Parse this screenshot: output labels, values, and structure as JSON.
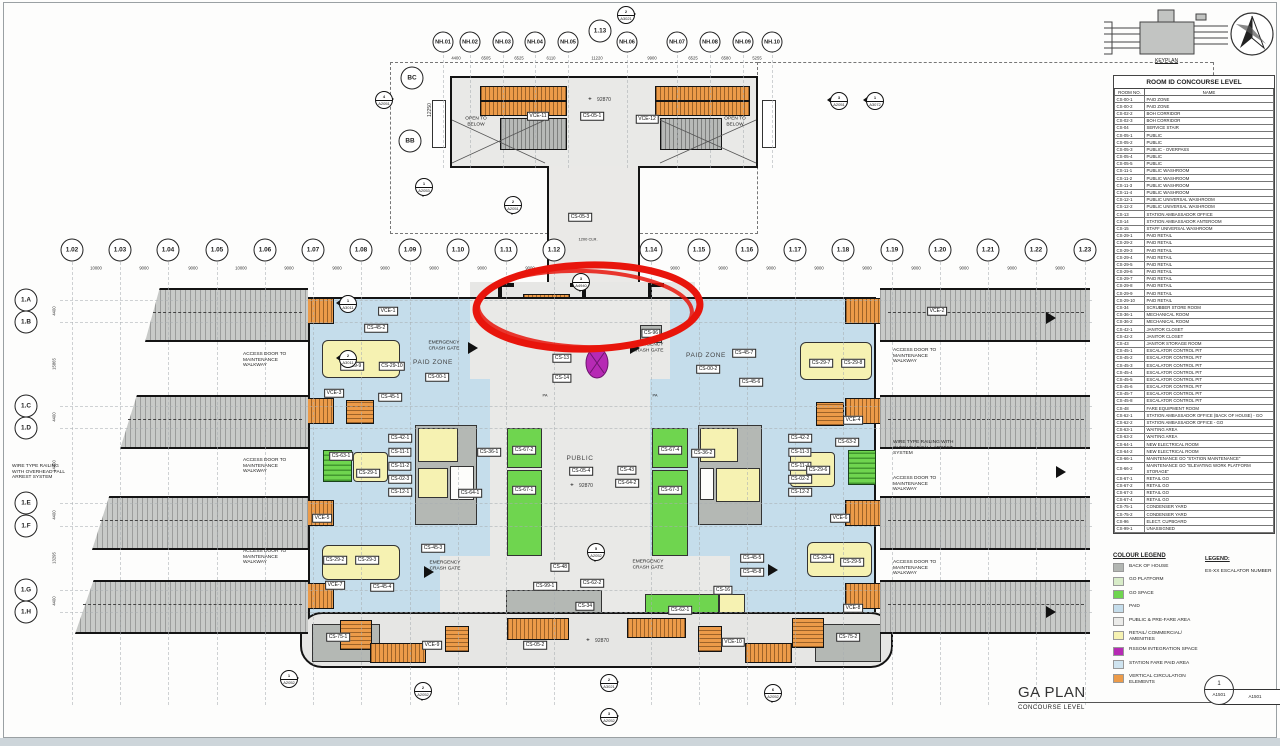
{
  "sheet": {
    "title": "GA PLAN",
    "subtitle": "CONCOURSE LEVEL",
    "detail_no": "1",
    "sheet_no": "A1501",
    "keyplan_label": "KEYPLAN"
  },
  "room_table": {
    "title": "ROOM ID CONCOURSE LEVEL",
    "col_no": "ROOM NO.",
    "col_name": "NAME",
    "rows": [
      [
        "CS-00-1",
        "PAID ZONE"
      ],
      [
        "CS-00-2",
        "PAID ZONE"
      ],
      [
        "CS-02-2",
        "BOH CORRIDOR"
      ],
      [
        "CS-02-3",
        "BOH CORRIDOR"
      ],
      [
        "CS-04",
        "SERVICE STAIR"
      ],
      [
        "CS-05-1",
        "PUBLIC"
      ],
      [
        "CS-05-2",
        "PUBLIC"
      ],
      [
        "CS-05-3",
        "PUBLIC - OVERPASS"
      ],
      [
        "CS-05-4",
        "PUBLIC"
      ],
      [
        "CS-05-5",
        "PUBLIC"
      ],
      [
        "CS-11-1",
        "PUBLIC WASHROOM"
      ],
      [
        "CS-11-2",
        "PUBLIC WASHROOM"
      ],
      [
        "CS-11-3",
        "PUBLIC WASHROOM"
      ],
      [
        "CS-11-4",
        "PUBLIC WASHROOM"
      ],
      [
        "CS-12-1",
        "PUBLIC UNIVERSAL WASHROOM"
      ],
      [
        "CS-12-2",
        "PUBLIC UNIVERSAL WASHROOM"
      ],
      [
        "CS-13",
        "STATION AMBASSADOR OFFICE"
      ],
      [
        "CS-14",
        "STATION AMBASSADOR ANTEROOM"
      ],
      [
        "CS-15",
        "STAFF UNIVERSAL WASHROOM"
      ],
      [
        "CS-29-1",
        "PAID RETAIL"
      ],
      [
        "CS-29-2",
        "PAID RETAIL"
      ],
      [
        "CS-29-3",
        "PAID RETAIL"
      ],
      [
        "CS-29-4",
        "PAID RETAIL"
      ],
      [
        "CS-29-5",
        "PAID RETAIL"
      ],
      [
        "CS-29-6",
        "PAID RETAIL"
      ],
      [
        "CS-29-7",
        "PAID RETAIL"
      ],
      [
        "CS-29-8",
        "PAID RETAIL"
      ],
      [
        "CS-29-9",
        "PAID RETAIL"
      ],
      [
        "CS-29-10",
        "PAID RETAIL"
      ],
      [
        "CS-34",
        "SCRUBBER STORE ROOM"
      ],
      [
        "CS-36-1",
        "MECHANICAL ROOM"
      ],
      [
        "CS-36-2",
        "MECHANICAL ROOM"
      ],
      [
        "CS-42-1",
        "JANITOR CLOSET"
      ],
      [
        "CS-42-2",
        "JANITOR CLOSET"
      ],
      [
        "CS-43",
        "JANITOR STORAGE ROOM"
      ],
      [
        "CS-45-1",
        "ESCALATOR CONTROL PIT"
      ],
      [
        "CS-45-2",
        "ESCALATOR CONTROL PIT"
      ],
      [
        "CS-45-3",
        "ESCALATOR CONTROL PIT"
      ],
      [
        "CS-45-4",
        "ESCALATOR CONTROL PIT"
      ],
      [
        "CS-45-5",
        "ESCALATOR CONTROL PIT"
      ],
      [
        "CS-45-6",
        "ESCALATOR CONTROL PIT"
      ],
      [
        "CS-45-7",
        "ESCALATOR CONTROL PIT"
      ],
      [
        "CS-45-8",
        "ESCALATOR CONTROL PIT"
      ],
      [
        "CS-48",
        "FARE EQUIPMENT ROOM"
      ],
      [
        "CS-62-1",
        "STATION AMBASSADOR OFFICE (BACK OF HOUSE) - GO"
      ],
      [
        "CS-62-2",
        "STATION AMBASSADOR OFFICE - GO"
      ],
      [
        "CS-63-1",
        "WAITING AREA"
      ],
      [
        "CS-63-2",
        "WAITING AREA"
      ],
      [
        "CS-64-1",
        "NEW ELECTRICAL ROOM"
      ],
      [
        "CS-64-2",
        "NEW ELECTRICAL ROOM"
      ],
      [
        "CS-66-1",
        "MAINTENANCE GO \"STATION MAINTENANCE\""
      ],
      [
        "CS-66-2",
        "MAINTENANCE GO \"ELEVATING WORK PLATFORM STORAGE\""
      ],
      [
        "CS-67-1",
        "RETAIL GO"
      ],
      [
        "CS-67-2",
        "RETAIL GO"
      ],
      [
        "CS-67-3",
        "RETAIL GO"
      ],
      [
        "CS-67-4",
        "RETAIL GO"
      ],
      [
        "CS-75-1",
        "CONDENSER YARD"
      ],
      [
        "CS-75-2",
        "CONDENSER YARD"
      ],
      [
        "CS-96",
        "ELECT. CUPBOARD"
      ],
      [
        "CS-99-1",
        "UNASSIGNED"
      ]
    ]
  },
  "colour_legend": {
    "title": "COLOUR LEGEND",
    "items": [
      {
        "label": "BACK OF HOUSE",
        "color": "#b2b6b2"
      },
      {
        "label": "GO PLATFORM",
        "color": "#d8ecc8"
      },
      {
        "label": "GO SPACE",
        "color": "#6fd54f"
      },
      {
        "label": "PAID",
        "color": "#c5ddeb"
      },
      {
        "label": "PUBLIC & PRE-FARE AREA",
        "color": "#ebebe9"
      },
      {
        "label": "RETAIL/ COMMERCIAL/ AMENITIES",
        "color": "#f6f2b2"
      },
      {
        "label": "RSSOM INTEGRATION SPACE",
        "color": "#b62ab4"
      },
      {
        "label": "STATION FARE PAID AREA",
        "color": "#cfe4f0"
      },
      {
        "label": "VERTICAL CIRCULATION ELEMENTS",
        "color": "#ec9b49"
      }
    ]
  },
  "legend": {
    "title": "LEGEND:",
    "items": [
      "ES-XX  ESCALATOR NUMBER"
    ]
  },
  "grid": {
    "top_cols": [
      {
        "label": "1.02",
        "x": 72
      },
      {
        "label": "1.03",
        "x": 120
      },
      {
        "label": "1.04",
        "x": 168
      },
      {
        "label": "1.05",
        "x": 217
      },
      {
        "label": "1.06",
        "x": 265
      },
      {
        "label": "1.07",
        "x": 313
      },
      {
        "label": "1.08",
        "x": 361
      },
      {
        "label": "1.09",
        "x": 410
      },
      {
        "label": "1.10",
        "x": 458
      },
      {
        "label": "1.11",
        "x": 506
      },
      {
        "label": "1.12",
        "x": 554
      },
      {
        "label": "1.14",
        "x": 651
      },
      {
        "label": "1.15",
        "x": 699
      },
      {
        "label": "1.16",
        "x": 747
      },
      {
        "label": "1.17",
        "x": 795
      },
      {
        "label": "1.18",
        "x": 843
      },
      {
        "label": "1.19",
        "x": 892
      },
      {
        "label": "1.20",
        "x": 940
      },
      {
        "label": "1.21",
        "x": 988
      },
      {
        "label": "1.22",
        "x": 1036
      },
      {
        "label": "1.23",
        "x": 1085
      }
    ],
    "top_dims": [
      {
        "text": "10000",
        "x": 96
      },
      {
        "text": "9000",
        "x": 144
      },
      {
        "text": "9000",
        "x": 193
      },
      {
        "text": "10000",
        "x": 241
      },
      {
        "text": "9000",
        "x": 289
      },
      {
        "text": "9000",
        "x": 337
      },
      {
        "text": "9000",
        "x": 385
      },
      {
        "text": "9000",
        "x": 434
      },
      {
        "text": "9000",
        "x": 482
      },
      {
        "text": "9000",
        "x": 530
      },
      {
        "text": "9000",
        "x": 675
      },
      {
        "text": "9000",
        "x": 723
      },
      {
        "text": "9000",
        "x": 771
      },
      {
        "text": "9000",
        "x": 819
      },
      {
        "text": "9000",
        "x": 867
      },
      {
        "text": "9000",
        "x": 916
      },
      {
        "text": "9000",
        "x": 964
      },
      {
        "text": "9000",
        "x": 1012
      },
      {
        "text": "9000",
        "x": 1060
      }
    ],
    "nh_cols": [
      {
        "label": "NH.01",
        "x": 443
      },
      {
        "label": "NH.02",
        "x": 470
      },
      {
        "label": "NH.03",
        "x": 503
      },
      {
        "label": "NH.04",
        "x": 535
      },
      {
        "label": "NH.05",
        "x": 568
      },
      {
        "label": "NH.06",
        "x": 627
      },
      {
        "label": "NH.07",
        "x": 677
      },
      {
        "label": "NH.08",
        "x": 710
      },
      {
        "label": "NH.09",
        "x": 743
      },
      {
        "label": "NH.10",
        "x": 772
      }
    ],
    "nh_dims": [
      {
        "text": "4400",
        "x": 456
      },
      {
        "text": "6505",
        "x": 486
      },
      {
        "text": "6525",
        "x": 519
      },
      {
        "text": "6110",
        "x": 551
      },
      {
        "text": "11220",
        "x": 597
      },
      {
        "text": "9900",
        "x": 652
      },
      {
        "text": "6525",
        "x": 693
      },
      {
        "text": "6580",
        "x": 726
      },
      {
        "text": "5255",
        "x": 757
      }
    ],
    "rows": [
      {
        "label": "1.A",
        "y": 300
      },
      {
        "label": "1.B",
        "y": 322
      },
      {
        "label": "1.C",
        "y": 406
      },
      {
        "label": "1.D",
        "y": 428
      },
      {
        "label": "1.E",
        "y": 503
      },
      {
        "label": "1.F",
        "y": 526
      },
      {
        "label": "1.G",
        "y": 590
      },
      {
        "label": "1.H",
        "y": 612
      }
    ],
    "row_dims": [
      {
        "text": "4400",
        "y": 311
      },
      {
        "text": "15865",
        "y": 364
      },
      {
        "text": "4400",
        "y": 417
      },
      {
        "text": "14400",
        "y": 466
      },
      {
        "text": "4400",
        "y": 515
      },
      {
        "text": "13295",
        "y": 558
      },
      {
        "text": "4400",
        "y": 601
      }
    ],
    "extra_bubbles": [
      {
        "label": "1.13",
        "x": 600,
        "y": 31
      },
      {
        "label": "BC",
        "x": 412,
        "y": 78
      },
      {
        "label": "BB",
        "x": 410,
        "y": 141
      }
    ]
  },
  "plan": {
    "labels": [
      {
        "t": "VCE-11",
        "x": 538,
        "y": 116
      },
      {
        "t": "CS-05-1",
        "x": 592,
        "y": 116
      },
      {
        "t": "VCE-12",
        "x": 647,
        "y": 119
      },
      {
        "t": "CS-05-3",
        "x": 580,
        "y": 217
      },
      {
        "t": "VCE-1",
        "x": 388,
        "y": 311
      },
      {
        "t": "CS-45-2",
        "x": 376,
        "y": 328
      },
      {
        "t": "VCE-2",
        "x": 937,
        "y": 311
      },
      {
        "t": "CS-29-9",
        "x": 352,
        "y": 366
      },
      {
        "t": "CS-29-10",
        "x": 392,
        "y": 366
      },
      {
        "t": "VCE-3",
        "x": 334,
        "y": 393
      },
      {
        "t": "CS-45-1",
        "x": 390,
        "y": 397
      },
      {
        "t": "CS-00-1",
        "x": 437,
        "y": 377
      },
      {
        "t": "CS-13",
        "x": 562,
        "y": 358
      },
      {
        "t": "CS-14",
        "x": 562,
        "y": 378
      },
      {
        "t": "CS-96",
        "x": 651,
        "y": 333
      },
      {
        "t": "CS-00-2",
        "x": 708,
        "y": 369
      },
      {
        "t": "CS-45-7",
        "x": 744,
        "y": 353
      },
      {
        "t": "CS-45-6",
        "x": 751,
        "y": 382
      },
      {
        "t": "CS-29-7",
        "x": 821,
        "y": 363
      },
      {
        "t": "CS-29-8",
        "x": 853,
        "y": 363
      },
      {
        "t": "VCE-4",
        "x": 853,
        "y": 420
      },
      {
        "t": "CS-42-1",
        "x": 400,
        "y": 438
      },
      {
        "t": "CS-11-1",
        "x": 400,
        "y": 452
      },
      {
        "t": "CS-11-2",
        "x": 400,
        "y": 466
      },
      {
        "t": "CS-02-3",
        "x": 400,
        "y": 479
      },
      {
        "t": "CS-12-1",
        "x": 400,
        "y": 492
      },
      {
        "t": "CS-29-1",
        "x": 368,
        "y": 473
      },
      {
        "t": "CS-63-1",
        "x": 341,
        "y": 456
      },
      {
        "t": "CS-36-1",
        "x": 489,
        "y": 452
      },
      {
        "t": "CS-64-1",
        "x": 470,
        "y": 493
      },
      {
        "t": "CS-67-2",
        "x": 524,
        "y": 450
      },
      {
        "t": "CS-67-1",
        "x": 524,
        "y": 490
      },
      {
        "t": "CS-05-4",
        "x": 581,
        "y": 471
      },
      {
        "t": "CS-43",
        "x": 627,
        "y": 470
      },
      {
        "t": "CS-64-2",
        "x": 627,
        "y": 483
      },
      {
        "t": "CS-67-4",
        "x": 670,
        "y": 450
      },
      {
        "t": "CS-67-3",
        "x": 670,
        "y": 490
      },
      {
        "t": "CS-36-2",
        "x": 703,
        "y": 453
      },
      {
        "t": "CS-42-2",
        "x": 800,
        "y": 438
      },
      {
        "t": "CS-11-3",
        "x": 800,
        "y": 452
      },
      {
        "t": "CS-11-4",
        "x": 800,
        "y": 466
      },
      {
        "t": "CS-02-2",
        "x": 800,
        "y": 479
      },
      {
        "t": "CS-12-2",
        "x": 800,
        "y": 492
      },
      {
        "t": "CS-63-2",
        "x": 847,
        "y": 442
      },
      {
        "t": "CS-29-6",
        "x": 818,
        "y": 470
      },
      {
        "t": "VCE-5",
        "x": 322,
        "y": 518
      },
      {
        "t": "VCE-6",
        "x": 840,
        "y": 518
      },
      {
        "t": "CS-45-3",
        "x": 433,
        "y": 548
      },
      {
        "t": "CS-29-2",
        "x": 335,
        "y": 560
      },
      {
        "t": "CS-29-3",
        "x": 367,
        "y": 560
      },
      {
        "t": "VCE-7",
        "x": 335,
        "y": 585
      },
      {
        "t": "CS-45-4",
        "x": 382,
        "y": 587
      },
      {
        "t": "CS-48",
        "x": 560,
        "y": 567
      },
      {
        "t": "CS-99-1",
        "x": 545,
        "y": 586
      },
      {
        "t": "CS-62-2",
        "x": 592,
        "y": 583
      },
      {
        "t": "CS-34",
        "x": 585,
        "y": 606
      },
      {
        "t": "CS-62-1",
        "x": 680,
        "y": 610
      },
      {
        "t": "CS-16",
        "x": 723,
        "y": 590
      },
      {
        "t": "CS-45-5",
        "x": 752,
        "y": 558
      },
      {
        "t": "CS-45-8",
        "x": 752,
        "y": 572
      },
      {
        "t": "CS-29-4",
        "x": 822,
        "y": 558
      },
      {
        "t": "CS-29-5",
        "x": 852,
        "y": 562
      },
      {
        "t": "VCE-8",
        "x": 853,
        "y": 608
      },
      {
        "t": "CS-75-1",
        "x": 338,
        "y": 637
      },
      {
        "t": "VCE-9",
        "x": 432,
        "y": 645
      },
      {
        "t": "CS-05-2",
        "x": 535,
        "y": 645
      },
      {
        "t": "VCE-10",
        "x": 733,
        "y": 642
      },
      {
        "t": "CS-75-2",
        "x": 848,
        "y": 637
      }
    ],
    "texts": [
      {
        "t": "OPEN TO\nBELOW",
        "x": 476,
        "y": 122,
        "c": 1
      },
      {
        "t": "OPEN TO\nBELOW",
        "x": 735,
        "y": 122,
        "c": 1
      },
      {
        "t": "PAID ZONE",
        "x": 433,
        "y": 363,
        "c": 1,
        "fs": 6.5
      },
      {
        "t": "PAID ZONE",
        "x": 706,
        "y": 356,
        "c": 1,
        "fs": 6.5
      },
      {
        "t": "PUBLIC",
        "x": 580,
        "y": 459,
        "c": 1,
        "fs": 6.5
      },
      {
        "t": "EMERGENCY\nCRASH GATE",
        "x": 444,
        "y": 346,
        "c": 1
      },
      {
        "t": "EMERGENCY\nCRASH GATE",
        "x": 648,
        "y": 348,
        "c": 1
      },
      {
        "t": "EMERGENCY\nCRASH GATE",
        "x": 445,
        "y": 566,
        "c": 1
      },
      {
        "t": "EMERGENCY\nCRASH GATE",
        "x": 648,
        "y": 565,
        "c": 1
      },
      {
        "t": "ACCESS DOOR TO\nMAINTENANCE\nWALKWAY",
        "x": 243,
        "y": 352,
        "c": 0
      },
      {
        "t": "ACCESS DOOR TO\nMAINTENANCE\nWALKWAY",
        "x": 243,
        "y": 458,
        "c": 0
      },
      {
        "t": "ACCESS DOOR TO\nMAINTENANCE\nWALKWAY",
        "x": 243,
        "y": 549,
        "c": 0
      },
      {
        "t": "ACCESS DOOR TO\nMAINTENANCE\nWALKWAY",
        "x": 893,
        "y": 348,
        "c": 0
      },
      {
        "t": "ACCESS DOOR TO\nMAINTENANCE\nWALKWAY",
        "x": 893,
        "y": 476,
        "c": 0
      },
      {
        "t": "ACCESS DOOR TO\nMAINTENANCE\nWALKWAY",
        "x": 893,
        "y": 560,
        "c": 0
      },
      {
        "t": "WIRE TYPE RAILING\nWITH OVERHEAD FALL\nARREST SYSTEM",
        "x": 12,
        "y": 464,
        "c": 0
      },
      {
        "t": "WIRE TYPE RAILING WITH\nOVERHEAD FALL ARREST\nSYSTEM",
        "x": 893,
        "y": 440,
        "c": 0
      },
      {
        "t": "PA",
        "x": 545,
        "y": 396,
        "c": 1,
        "fs": 4
      },
      {
        "t": "PA",
        "x": 655,
        "y": 396,
        "c": 1,
        "fs": 4
      },
      {
        "t": "1200 CLR.",
        "x": 588,
        "y": 240,
        "c": 1,
        "fs": 4
      }
    ],
    "dims": [
      {
        "t": "92870",
        "x": 604,
        "y": 100
      },
      {
        "t": "92870",
        "x": 586,
        "y": 486
      },
      {
        "t": "92870",
        "x": 602,
        "y": 641
      },
      {
        "t": "12250",
        "x": 430,
        "y": 110,
        "r": 1
      }
    ],
    "markers": [
      {
        "n": "2",
        "s": "A3021",
        "x": 625,
        "y": 14,
        "d": "right"
      },
      {
        "n": "4",
        "s": "A2051",
        "x": 383,
        "y": 99,
        "d": "right"
      },
      {
        "n": "3",
        "s": "A2051",
        "x": 838,
        "y": 100,
        "d": "left"
      },
      {
        "n": "1",
        "s": "A3072",
        "x": 874,
        "y": 100,
        "d": "left"
      },
      {
        "n": "1",
        "s": "A2053",
        "x": 423,
        "y": 186,
        "d": "down"
      },
      {
        "n": "2",
        "s": "A2051",
        "x": 512,
        "y": 204,
        "d": "down"
      },
      {
        "n": "3",
        "s": "A4940",
        "x": 580,
        "y": 281,
        "d": "down"
      },
      {
        "n": "1",
        "s": "A3011",
        "x": 347,
        "y": 303,
        "d": "left"
      },
      {
        "n": "2",
        "s": "A3011",
        "x": 347,
        "y": 358,
        "d": "left"
      },
      {
        "n": "5",
        "s": "A2052",
        "x": 595,
        "y": 551,
        "d": "down"
      },
      {
        "n": "1",
        "s": "A2052",
        "x": 288,
        "y": 678,
        "d": "right"
      },
      {
        "n": "2",
        "s": "A2052",
        "x": 422,
        "y": 690,
        "d": "down"
      },
      {
        "n": "2",
        "s": "A3021",
        "x": 608,
        "y": 682,
        "d": "right"
      },
      {
        "n": "3",
        "s": "A2052",
        "x": 608,
        "y": 716,
        "d": "right"
      },
      {
        "n": "6",
        "s": "A2052",
        "x": 772,
        "y": 692,
        "d": "down"
      }
    ],
    "annotation_color": "#e8150c",
    "rssom_color": "#b62ab4"
  }
}
